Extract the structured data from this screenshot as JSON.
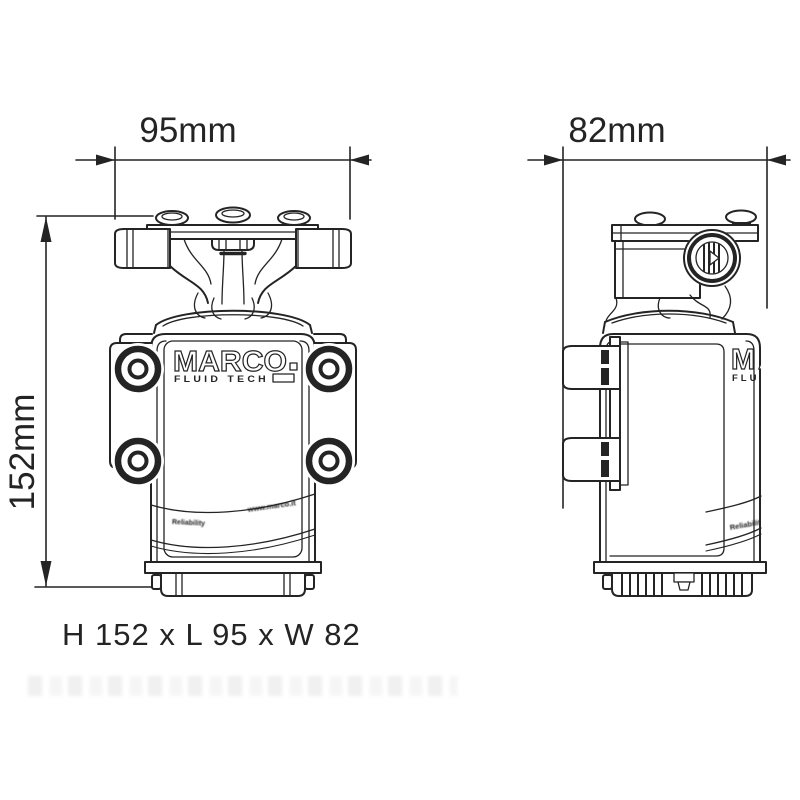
{
  "diagram": {
    "views": {
      "front": {
        "length_dimension": "95mm",
        "height_dimension": "152mm"
      },
      "side": {
        "width_dimension": "82mm"
      }
    },
    "summary": "H 152 x L 95 x W 82",
    "logo": {
      "brand": "MARCO",
      "tagline": "FLUID TECH"
    },
    "body_band": {
      "left_label": "Reliability",
      "right_label": "www.marco.it"
    },
    "colors": {
      "line": "#242424",
      "background": "#ffffff"
    }
  }
}
